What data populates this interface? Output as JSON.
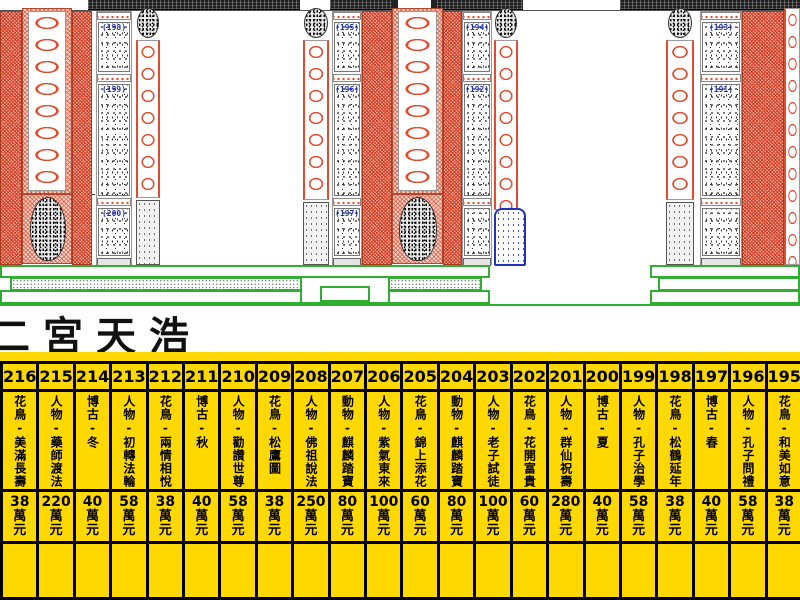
{
  "title": {
    "text": "二宮天浩"
  },
  "drawing": {
    "description": "temple stone facade elevation",
    "groups": [
      {
        "labels": [
          "(198)",
          "(199)",
          "(200)"
        ]
      },
      {
        "labels": [
          "(195)",
          "(196)",
          "(197)"
        ]
      },
      {
        "labels": [
          "(194)",
          "(192)"
        ]
      },
      {
        "labels": [
          "(193)",
          "(191)"
        ]
      }
    ]
  },
  "colors": {
    "hatch_red": "#e24b2e",
    "table_yellow": "#ffd800",
    "base_green": "#2fae2f",
    "label_blue": "#2233bb",
    "beam_black": "#1e1e1e"
  },
  "price_table": {
    "unit_wan": "萬",
    "unit_yuan": "元",
    "items": [
      {
        "no": 216,
        "desc": "花鳥-美滿長壽",
        "price": "38"
      },
      {
        "no": 215,
        "desc": "人物-藥師渡法",
        "price": "220"
      },
      {
        "no": 214,
        "desc": "博古-冬",
        "price": "40"
      },
      {
        "no": 213,
        "desc": "人物-初轉法輪",
        "price": "58"
      },
      {
        "no": 212,
        "desc": "花鳥-兩情相悅",
        "price": "38"
      },
      {
        "no": 211,
        "desc": "博古-秋",
        "price": "40"
      },
      {
        "no": 210,
        "desc": "人物-勸讚世尊",
        "price": "58"
      },
      {
        "no": 209,
        "desc": "花鳥-松鷹圖",
        "price": "38"
      },
      {
        "no": 208,
        "desc": "人物-佛祖說法",
        "price": "250"
      },
      {
        "no": 207,
        "desc": "動物-麒麟踏寶",
        "price": "80"
      },
      {
        "no": 206,
        "desc": "人物-紫氣東來",
        "price": "100"
      },
      {
        "no": 205,
        "desc": "花鳥-錦上添花",
        "price": "60"
      },
      {
        "no": 204,
        "desc": "動物-麒麟踏寶",
        "price": "80"
      },
      {
        "no": 203,
        "desc": "人物-老子試徒",
        "price": "100"
      },
      {
        "no": 202,
        "desc": "花鳥-花開富貴",
        "price": "60"
      },
      {
        "no": 201,
        "desc": "人物-群仙祝壽",
        "price": "280"
      },
      {
        "no": 200,
        "desc": "博古-夏",
        "price": "40"
      },
      {
        "no": 199,
        "desc": "人物-孔子治學",
        "price": "58"
      },
      {
        "no": 198,
        "desc": "花鳥-松鶴延年",
        "price": "38"
      },
      {
        "no": 197,
        "desc": "博古-春",
        "price": "40"
      },
      {
        "no": 196,
        "desc": "人物-孔子問禮",
        "price": "58"
      },
      {
        "no": 195,
        "desc": "花鳥-和美如意",
        "price": "38"
      },
      {
        "no": 194,
        "desc": "人物-孔子授學",
        "price": "250"
      },
      {
        "no": 193,
        "desc": "人物-棋",
        "price": "40"
      },
      {
        "no": 192,
        "desc": "博古-蓮年如意",
        "price": "58"
      }
    ]
  }
}
